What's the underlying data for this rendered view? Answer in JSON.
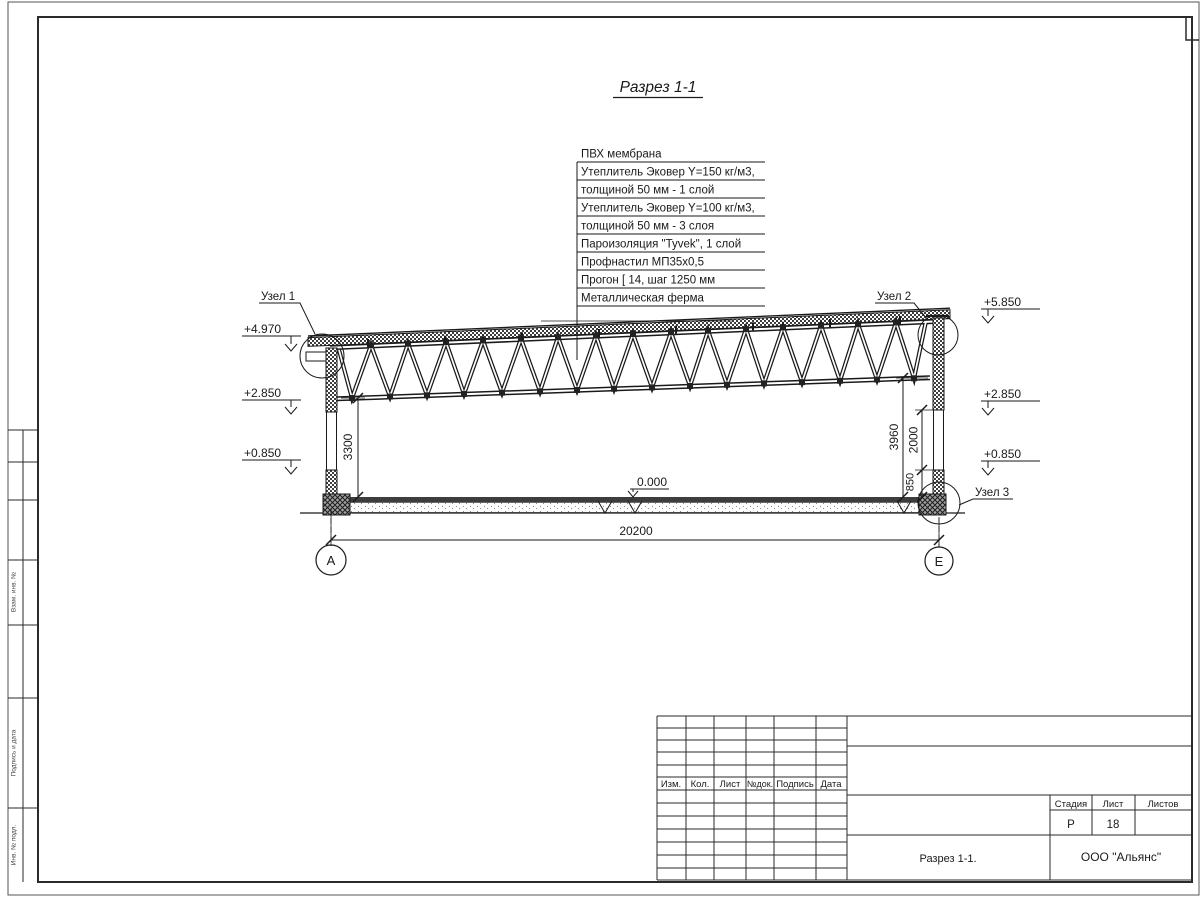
{
  "drawing": {
    "title": "Разрез 1-1",
    "callout": {
      "layers": [
        "ПВХ мембрана",
        "Утеплитель Эковер Y=150 кг/м3,",
        "толщиной 50 мм - 1 слой",
        "Утеплитель Эковер Y=100 кг/м3,",
        "толщиной 50 мм - 3 слоя",
        "Пароизоляция \"Tyvek\", 1 слой",
        "Профнастил МП35х0,5",
        "Прогон [ 14, шаг 1250 мм",
        "Металлическая ферма"
      ]
    },
    "nodes": {
      "n1": "Узел 1",
      "n2": "Узел 2",
      "n3": "Узел 3"
    },
    "elev": {
      "l1": "+4.970",
      "l2": "+2.850",
      "l3": "+0.850",
      "r1": "+5.850",
      "r2": "+2.850",
      "r3": "+0.850",
      "zero": "0.000"
    },
    "dims": {
      "span": "20200",
      "h_left": "3300",
      "h_right": "3960",
      "window": "2000",
      "sill": "850"
    },
    "axes": {
      "a": "А",
      "e": "Е"
    }
  },
  "title_block": {
    "cols": [
      "Изм.",
      "Кол.",
      "Лист",
      "№док.",
      "Подпись",
      "Дата"
    ],
    "stage_label": "Стадия",
    "sheet_label": "Лист",
    "sheets_label": "Листов",
    "stage_value": "Р",
    "sheet_value": "18",
    "drawing_name": "Разрез 1-1.",
    "company": "ООО \"Альянс\""
  },
  "side_stamp": {
    "s1": "Взам. инв. №",
    "s2": "Подпись и дата",
    "s3": "Инв. № подл."
  }
}
